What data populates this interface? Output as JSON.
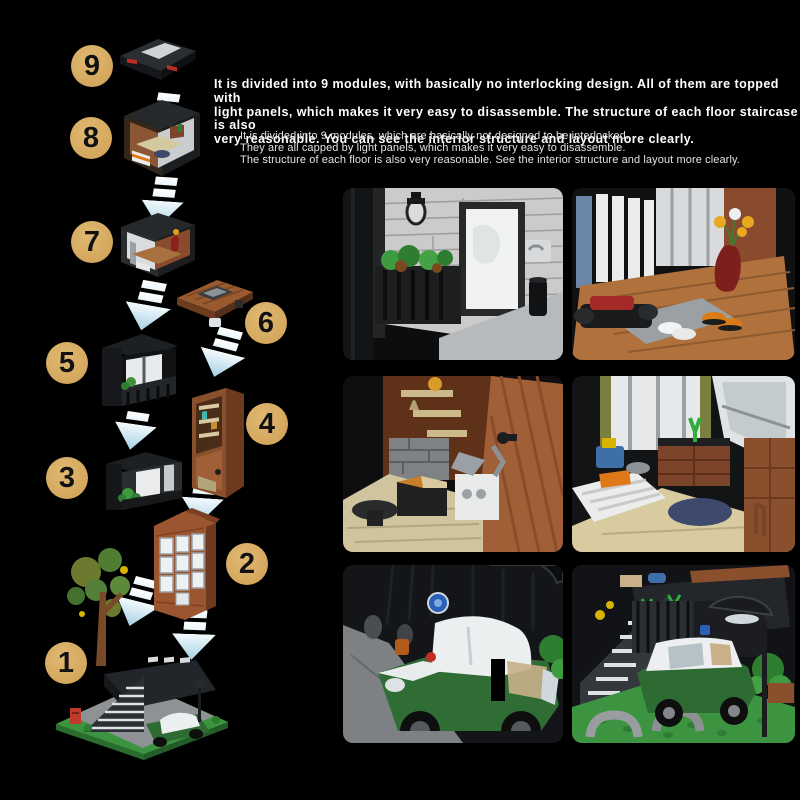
{
  "title_block": {
    "headline_lines": [
      "It is divided into 9 modules, with basically no interlocking design. All of them are topped with",
      "light panels, which makes it very easy to disassemble. The structure of each floor staircase is also",
      "very reasonable. You can see the interior structure and layout more clearly."
    ],
    "subtext_lines": [
      "It is divided into 9 modules, which are basically not designed to be interlocked.",
      "They are all capped by light panels, which makes it very easy to disassemble.",
      "The structure of each floor is also very reasonable. See the interior structure and layout more clearly."
    ]
  },
  "modules": [
    {
      "number": "1",
      "name": "ground floor base with stairs, green car, mailbox and tree"
    },
    {
      "number": "2",
      "name": "brick bay-window tower with white window grid"
    },
    {
      "number": "3",
      "name": "dark balcony room with white door and plants"
    },
    {
      "number": "4",
      "name": "tall wooden cabinet wall section"
    },
    {
      "number": "5",
      "name": "black framed balcony room"
    },
    {
      "number": "6",
      "name": "wooden roof / table piece"
    },
    {
      "number": "7",
      "name": "entry hall room with red vase"
    },
    {
      "number": "8",
      "name": "bedroom module with bed and desk"
    },
    {
      "number": "9",
      "name": "flat roof light panel"
    }
  ],
  "detail_photos": [
    {
      "id": "entrance-balcony",
      "position": "top-left",
      "description": "White brick wall, black planter with green plants, wall lantern, white door and black cylinder bin"
    },
    {
      "id": "entry-hall",
      "position": "top-right",
      "description": "Entry hall with wood floor, dark red vase with yellow flowers, bench with red cushion and slippers"
    },
    {
      "id": "study-corner",
      "position": "middle-left",
      "description": "Corner with wooden door, shelves with goblet, gray bricks, white desk with lamp, box and stool"
    },
    {
      "id": "bedroom",
      "position": "middle-right",
      "description": "Bedroom with window and olive curtains, skylight, dressers, striped bed with orange pillow and blue rug"
    },
    {
      "id": "garage",
      "position": "bottom-left",
      "description": "Garage interior with green classic car with white roof and blue round wall badge"
    },
    {
      "id": "yard-staircase",
      "position": "bottom-right",
      "description": "Yard with gray staircase, green car, dome street lamp, green baseplate and gray pipes"
    }
  ],
  "colors": {
    "background": "#000000",
    "badge_fill": "#d5a95f",
    "badge_text": "#121212",
    "arrow_white": "#ffffff",
    "arrow_blue": "#a6d0e4",
    "headline_text": "#ffffff",
    "subtext_text": "#e2e2e2"
  }
}
